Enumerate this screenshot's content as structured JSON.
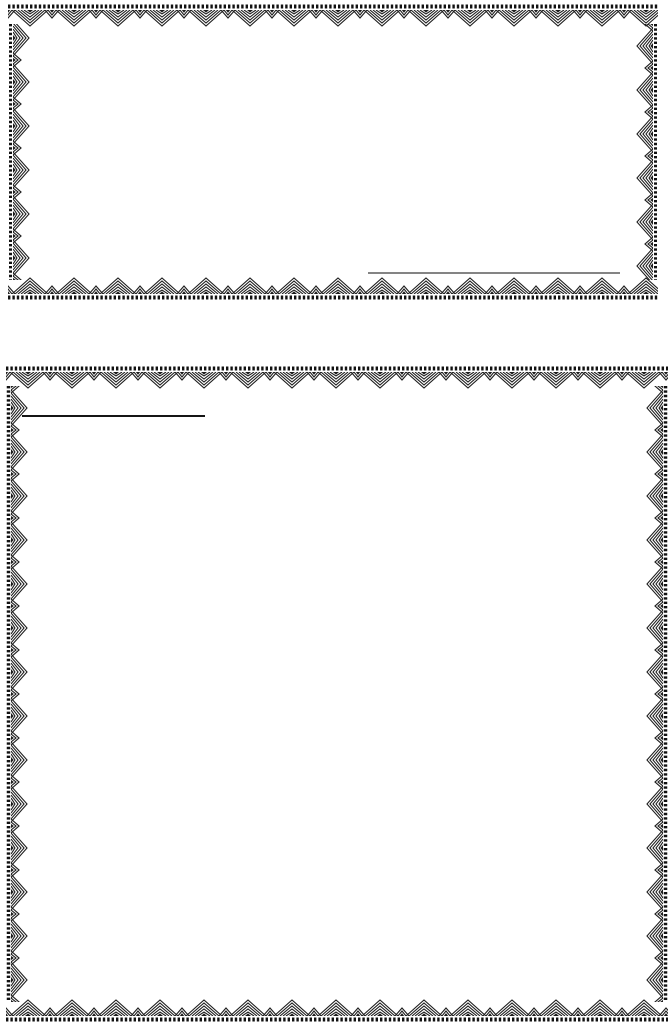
{
  "page": {
    "background_color": "#ffffff",
    "content_text": ""
  },
  "frames": [
    {
      "id": "top-frame",
      "border_style": "ornamental-lace",
      "border_color": "#1d1d1d",
      "bead_color": "#111111",
      "interior_text": "",
      "rule_line": {
        "position": "bottom-right-interior",
        "color": "#3b3b3b"
      }
    },
    {
      "id": "bottom-frame",
      "border_style": "ornamental-lace",
      "border_color": "#1d1d1d",
      "bead_color": "#111111",
      "interior_text": "",
      "rule_line": {
        "position": "top-left-interior",
        "color": "#151515"
      }
    }
  ]
}
